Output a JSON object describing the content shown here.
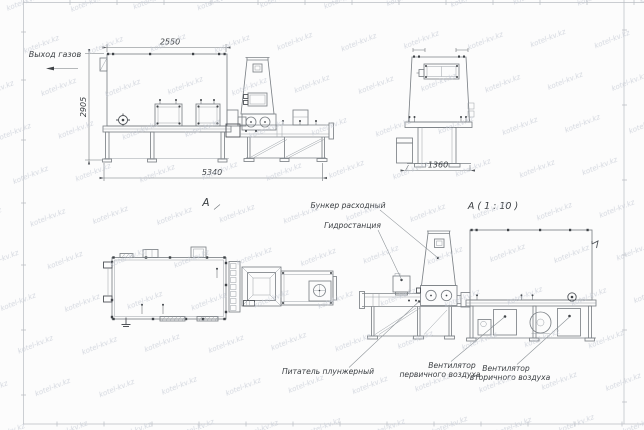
{
  "drawing": {
    "watermark": {
      "text": "kotel-kv.kz"
    },
    "side_view": {
      "dim_top": "2550",
      "dim_height": "2905",
      "dim_length": "5340",
      "gas_outlet": "Выход газов",
      "view_letter": "A"
    },
    "end_view": {
      "dim_width": "1360"
    },
    "detail_view": {
      "title": "A ( 1 : 10 )",
      "callout_hopper": "Бункер расходный",
      "callout_hydro": "Гидростанция",
      "callout_feeder": "Питатель плунжерный",
      "callout_fan_primary": [
        "Вентилятор",
        "первичного воздуха"
      ],
      "callout_fan_secondary": [
        "Вентилятор",
        "вторичного воздуха"
      ]
    },
    "colors": {
      "background": "#fcfcfc",
      "line": "#7d8287",
      "dark": "#4e5257",
      "text": "#3a3e42",
      "frame": "#b9bdc2",
      "watermark": "#c6cbd5"
    }
  }
}
